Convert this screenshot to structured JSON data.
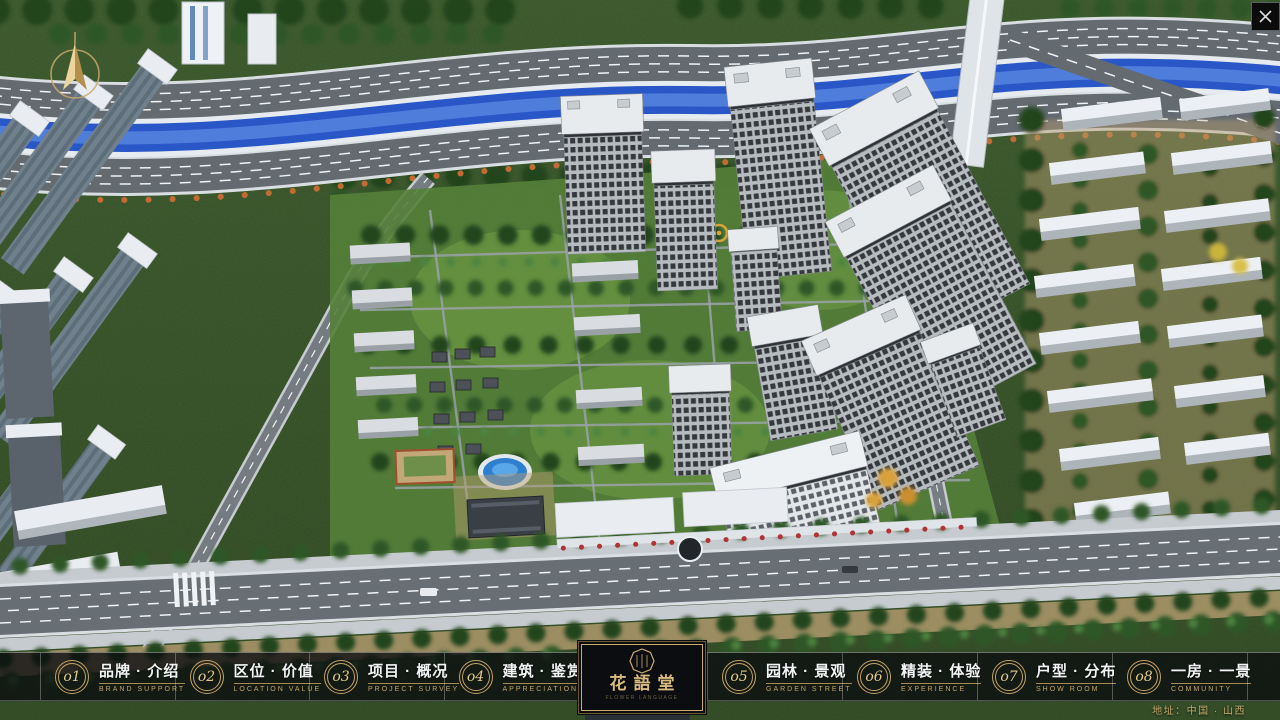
{
  "window": {
    "close_glyph": "✕"
  },
  "nav": {
    "items": [
      {
        "num": "o1",
        "zh": "品牌 · 介绍",
        "en": "BRAND SUPPORT"
      },
      {
        "num": "o2",
        "zh": "区位 · 价值",
        "en": "LOCATION VALUE"
      },
      {
        "num": "o3",
        "zh": "项目 · 概况",
        "en": "PROJECT SURVEY"
      },
      {
        "num": "o4",
        "zh": "建筑 · 鉴赏",
        "en": "APPRECIATION"
      },
      {
        "num": "o5",
        "zh": "园林 · 景观",
        "en": "GARDEN STREET"
      },
      {
        "num": "o6",
        "zh": "精装 · 体验",
        "en": "EXPERIENCE"
      },
      {
        "num": "o7",
        "zh": "户型 · 分布",
        "en": "SHOW ROOM"
      },
      {
        "num": "o8",
        "zh": "一房 · 一景",
        "en": "COMMUNITY"
      }
    ]
  },
  "logo": {
    "title": "花語堂",
    "subtitle": "FLOWER LANGUAGE",
    "seal_icon": "octagonal-seal"
  },
  "footer": {
    "address": "地址：中国 · 山西"
  },
  "icons": {
    "compass": "north-arrow-compass",
    "close": "close-x"
  },
  "colors": {
    "gold_accent": "#c9ab6e",
    "nav_bar_bg": "rgba(10,12,15,0.78)",
    "nav_text": "#f2f3f4",
    "nav_en_text": "#c2a567",
    "river_blue": "#2a57c8",
    "road_gray": "#636a70",
    "greenery_dark": "#24451e",
    "tower_facade": "#b6bbbf",
    "roof_white": "#e9edf2"
  }
}
